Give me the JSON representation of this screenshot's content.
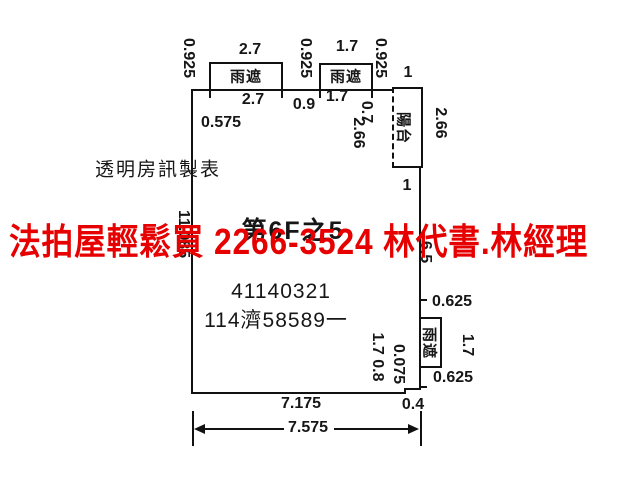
{
  "watermark": {
    "text": "法拍屋輕鬆買  2266-3524  林代書.林經理",
    "color": "#e60000"
  },
  "maker": "透明房訊製表",
  "rooms": {
    "balcony": "陽台",
    "canopy": "雨遮"
  },
  "numbers": {
    "plan_no": "41140321",
    "case_no": "114濟58589一",
    "unit": "第6F之5"
  },
  "dims": {
    "d0925": "0.925",
    "d27": "2.7",
    "d17": "1.7",
    "d1": "1",
    "d09": "0.9",
    "d07": "0.7",
    "d266": "2.66",
    "d0575": "0.575",
    "d11085": "11.085",
    "d65": "6.5",
    "d0625": "0.625",
    "d0075": "0.075",
    "d17_08": "1.7 0.8",
    "d7175": "7.175",
    "d04": "0.4",
    "d7575": "7.575"
  },
  "colors": {
    "watermark": "#e60000",
    "line": "#111111",
    "background": "#ffffff"
  }
}
